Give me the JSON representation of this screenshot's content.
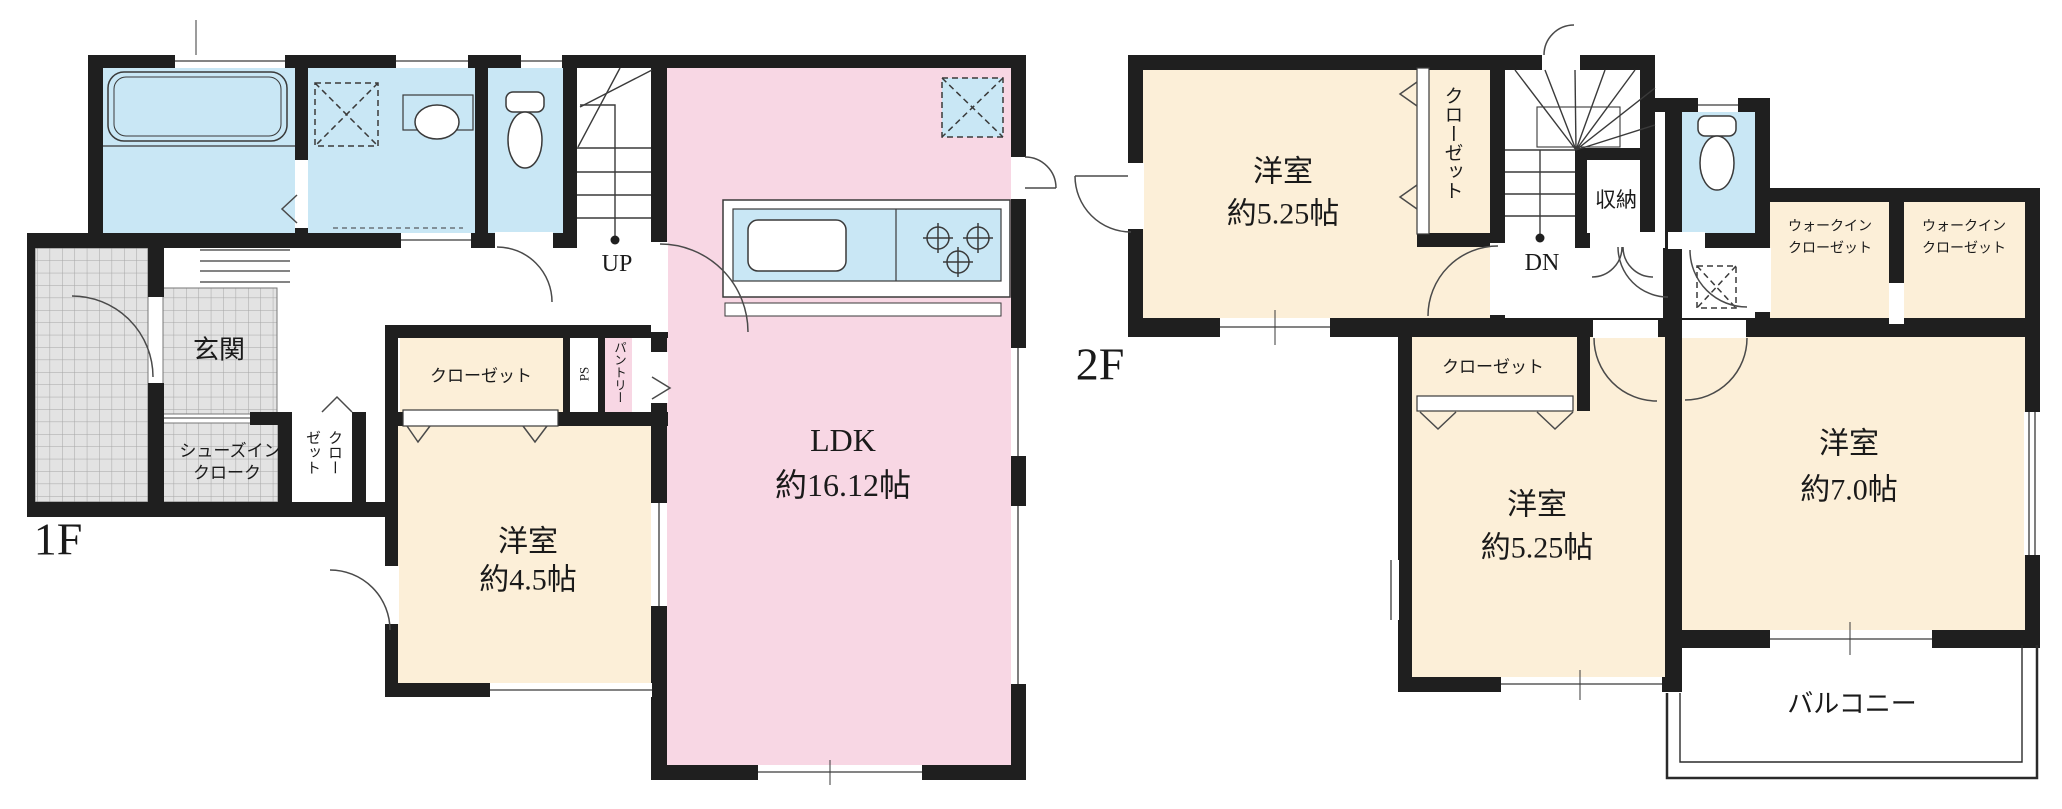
{
  "plan": {
    "colors": {
      "wall": "#1f1f1f",
      "room_cream": "#fcefd8",
      "room_pink": "#f8d7e4",
      "water_blue": "#c9e7f5",
      "tile_gray": "#e3e3e3",
      "tile_line": "#a6a6a6",
      "line": "#3a3a3a"
    },
    "floor1": {
      "label": "1F",
      "entrance": "玄関",
      "shoes_cloak_line1": "シューズイン",
      "shoes_cloak_line2": "クローク",
      "small_closet_col1": "クロー",
      "small_closet_col2": "ゼット",
      "closet": "クローゼット",
      "ps": "PS",
      "pantry": "パントリー",
      "bedroom_name": "洋室",
      "bedroom_size": "約4.5帖",
      "ldk_name": "LDK",
      "ldk_size": "約16.12帖",
      "stairs_up": "UP"
    },
    "floor2": {
      "label": "2F",
      "bedroom1_name": "洋室",
      "bedroom1_size": "約5.25帖",
      "closet_vertical": "クローゼット",
      "storage": "収納",
      "stairs_dn": "DN",
      "wic1_line1": "ウォークイン",
      "wic1_line2": "クローゼット",
      "wic2_line1": "ウォークイン",
      "wic2_line2": "クローゼット",
      "closet_mid": "クローゼット",
      "bedroom2_name": "洋室",
      "bedroom2_size": "約5.25帖",
      "bedroom3_name": "洋室",
      "bedroom3_size": "約7.0帖",
      "balcony": "バルコニー"
    }
  }
}
